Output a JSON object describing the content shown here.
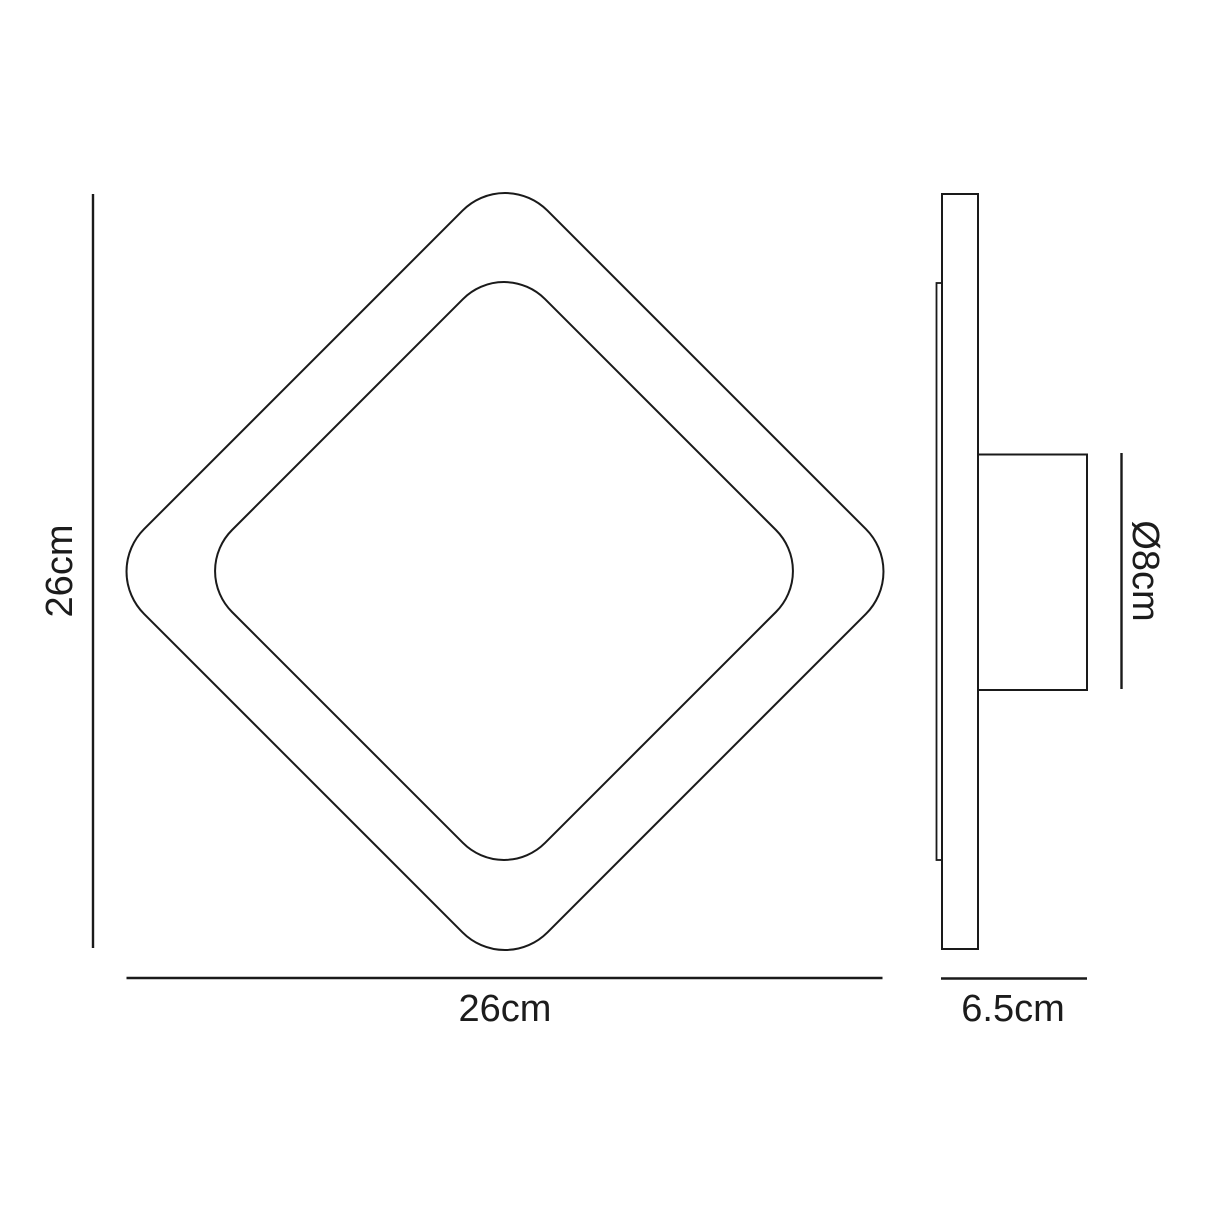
{
  "diagram": {
    "type": "product-dimension-drawing",
    "product": "square wall light",
    "front_view": {
      "height_label": "26cm",
      "width_label": "26cm"
    },
    "side_view": {
      "depth_label": "6.5cm",
      "diameter_label": "Ø8cm"
    },
    "colors": {
      "background": "#ffffff",
      "line": "#1a1a1a",
      "text": "#1c1c1c"
    }
  }
}
